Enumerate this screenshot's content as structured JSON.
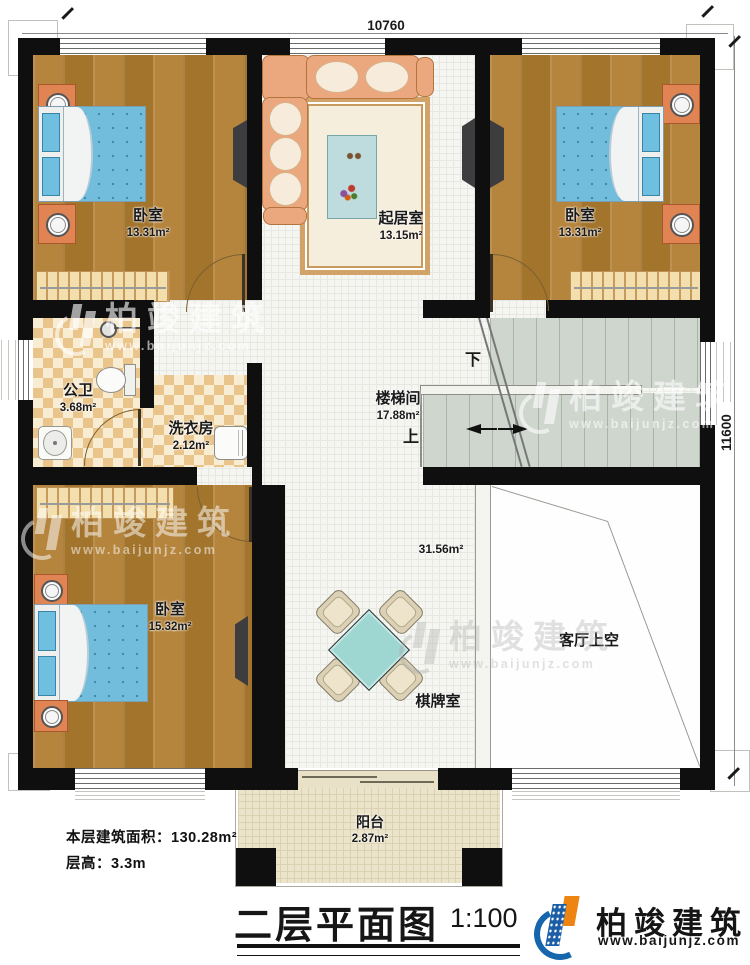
{
  "plan": {
    "dimensions": {
      "width_top": "10760",
      "height_right": "11600"
    },
    "rooms": {
      "bedroom_top_left": {
        "name": "卧室",
        "area": "13.31m²"
      },
      "living_room": {
        "name": "起居室",
        "area": "13.15m²"
      },
      "bedroom_top_right": {
        "name": "卧室",
        "area": "13.31m²"
      },
      "bathroom": {
        "name": "公卫",
        "area": "3.68m²"
      },
      "laundry": {
        "name": "洗衣房",
        "area": "2.12m²"
      },
      "stairwell": {
        "name": "楼梯间",
        "area": "17.88m²",
        "up_label": "上",
        "down_label": "下"
      },
      "bedroom_bottom": {
        "name": "卧室",
        "area": "15.32m²"
      },
      "game_room": {
        "name": "棋牌室",
        "area": "31.56m²"
      },
      "void": {
        "name": "客厅上空"
      },
      "balcony": {
        "name": "阳台",
        "area": "2.87m²"
      }
    }
  },
  "footer": {
    "floor_area_line": "本层建筑面积：130.28m²",
    "floor_height_line": "层高：3.3m",
    "title": "二层平面图",
    "scale": "1:100"
  },
  "brand": {
    "name": "柏竣建筑",
    "website": "www.baijunjz.com"
  },
  "watermark": {
    "name": "柏竣建筑",
    "website": "www.baijunjz.com"
  },
  "colors": {
    "wall": "#0f0f0f",
    "wood_floor": "#ac7b33",
    "tile_checker": "#e9c48b",
    "bed": "#72bcdc",
    "stairs": "#cfd6ce",
    "balcony_floor": "#ece4ca",
    "game_table": "#9ed6d2",
    "logo_blue": "#1566ac",
    "logo_orange": "#ee8411"
  }
}
